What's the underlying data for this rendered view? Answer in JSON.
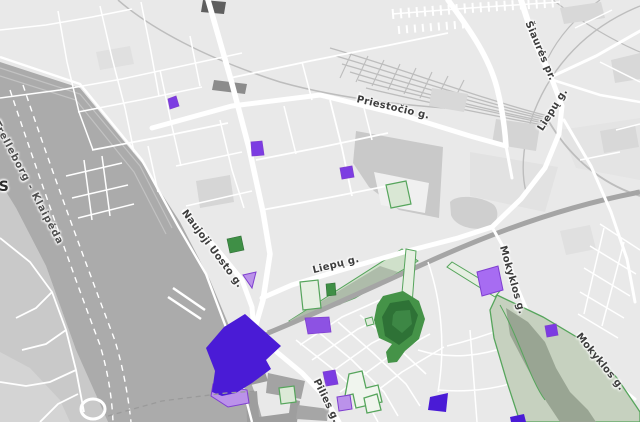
{
  "map": {
    "region": "Klaipėda old town and harbour",
    "labels": [
      {
        "id": "ferry-route",
        "text": "Trelleborg - Klaipėda"
      },
      {
        "id": "city-partial",
        "text": "S"
      },
      {
        "id": "priestocio",
        "text": "Priestočio g."
      },
      {
        "id": "siaures",
        "text": "Šiaurės pr."
      },
      {
        "id": "liepu-north",
        "text": "Liepų g."
      },
      {
        "id": "naujoji-uosto",
        "text": "Naujoji Uosto g."
      },
      {
        "id": "liepu-center",
        "text": "Liepų g."
      },
      {
        "id": "pilies",
        "text": "Pilies g."
      },
      {
        "id": "mokyklos-north",
        "text": "Mokyklos g."
      },
      {
        "id": "mokyklos-south",
        "text": "Mokyklos g."
      }
    ],
    "colors": {
      "land": "#e9e9e9",
      "land_west": "#c9c9c9",
      "land_west_light": "#d4d4d4",
      "water": "#ababab",
      "road": "#ffffff",
      "road_gray": "#a5a5a5",
      "rail": "#bdbdbd",
      "block": "#d8d8d8",
      "block_dark": "#9e9e9e",
      "building_charcoal": "#5f5f5f",
      "park_fill": "#cfe0ca",
      "park_inner": "#aebcaa",
      "park_stroke": "#56a55c",
      "park_big_fill": "#c6d1bf",
      "park_big_inner": "#99a593",
      "hill_outer": "#459348",
      "hill_ring": "#2e7236",
      "hill_center": "#3d8745",
      "green_solid": "#3f8f46",
      "green_pale": "#e6efe2",
      "purple_deep": "#4a1bd6",
      "purple_mid": "#7c3ce2",
      "purple_light": "#bb92ea",
      "purple_bright": "#a76cf2",
      "purple_stroke": "#7f3fd0",
      "label": "#3d3d3d",
      "ferry_dash": "#ffffff"
    }
  }
}
